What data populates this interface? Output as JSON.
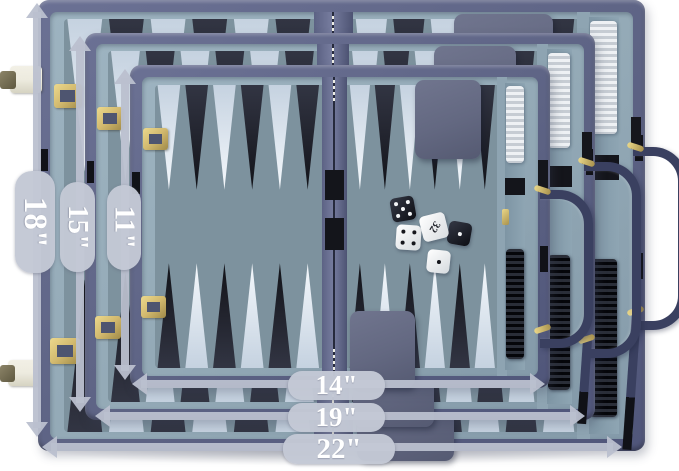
{
  "annotations": {
    "vertical_labels": [
      {
        "label": "18\"",
        "meaning": "height of large open case"
      },
      {
        "label": "15\"",
        "meaning": "height of medium open case"
      },
      {
        "label": "11\"",
        "meaning": "height of small open case"
      }
    ],
    "horizontal_labels": [
      {
        "label": "14\"",
        "meaning": "width of small open case"
      },
      {
        "label": "19\"",
        "meaning": "width of medium open case"
      },
      {
        "label": "22\"",
        "meaning": "width of large open case"
      }
    ]
  },
  "doubling_cube": {
    "value": "32"
  },
  "dice": [
    {
      "color": "black",
      "pips": 5
    },
    {
      "color": "white",
      "pips": 4
    },
    {
      "color": "black",
      "pips": 1
    },
    {
      "color": "white",
      "pips": 1
    }
  ],
  "cases": [
    {
      "name": "large-case",
      "height_label": "18\"",
      "width_label": "22\""
    },
    {
      "name": "medium-case",
      "height_label": "15\"",
      "width_label": "19\""
    },
    {
      "name": "small-case",
      "height_label": "11\"",
      "width_label": "14\""
    }
  ],
  "colors": {
    "background": "#ffffff",
    "case_shell": "#5d6384",
    "case_inner_wall": "#93a9b6",
    "board_field": "#7d929e",
    "point_light": "#e4edf5",
    "point_dark": "#23252e",
    "hinge": "#6a7190",
    "dice_cup": "#636881",
    "checker_white": "#e2e6ea",
    "checker_black": "#14161c",
    "handle": "#3a4060",
    "gold_hardware": "#d2b96e",
    "ivory_latch": "#edebdf",
    "annotation_gray": "#c3c8d5",
    "annotation_text": "#ffffff"
  }
}
